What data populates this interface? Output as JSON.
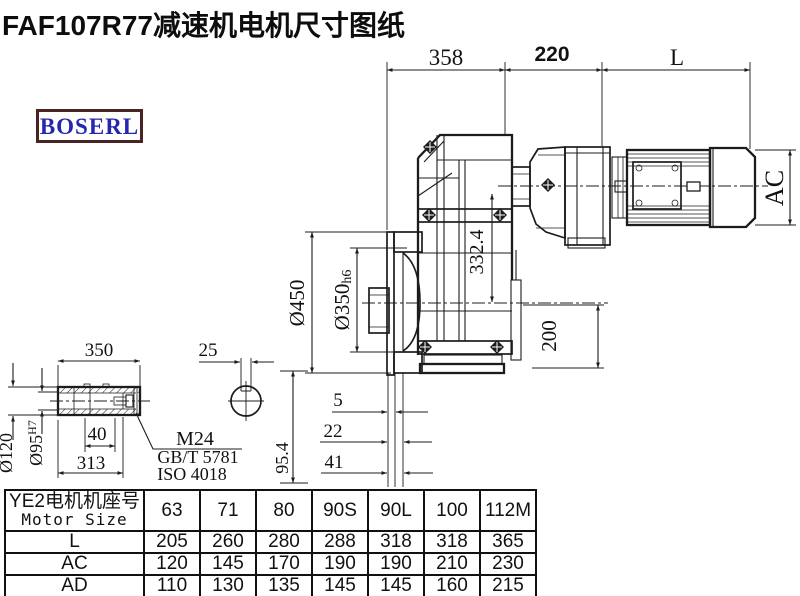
{
  "title": "FAF107R77减速机电机尺寸图纸",
  "logo": {
    "text": "BOSERL"
  },
  "colors": {
    "line": "#1c1c1c",
    "logo_border": "#4a2424",
    "logo_text": "#2726ae"
  },
  "dims": {
    "top_width": "358",
    "top_adapter": "220",
    "top_motor": "L",
    "motor_dia": "AC",
    "axis_offset": "332.4",
    "flange_od": "Ø450",
    "spigot": "Ø350",
    "spigot_tol": "h6",
    "foot": "200",
    "face_5": "5",
    "face_22": "22",
    "face_41": "41",
    "key_height": "95.4",
    "shaft_len": "350",
    "key_width": "25",
    "screw_depth": "40",
    "shaft_inner": "313",
    "hub_od": "Ø120",
    "bore": "Ø95",
    "bore_tol": "H7",
    "screw": "M24",
    "screw_std1": "GB/T 5781",
    "screw_std2": "ISO 4018"
  },
  "table": {
    "header_cn": "YE2电机机座号",
    "header_en": "Motor Size",
    "columns": [
      "63",
      "71",
      "80",
      "90S",
      "90L",
      "100",
      "112M"
    ],
    "rows": [
      {
        "label": "L",
        "values": [
          "205",
          "260",
          "280",
          "288",
          "318",
          "318",
          "365"
        ]
      },
      {
        "label": "AC",
        "values": [
          "120",
          "145",
          "170",
          "190",
          "190",
          "210",
          "230"
        ]
      },
      {
        "label": "AD",
        "values": [
          "110",
          "130",
          "135",
          "145",
          "145",
          "160",
          "215"
        ]
      }
    ]
  }
}
